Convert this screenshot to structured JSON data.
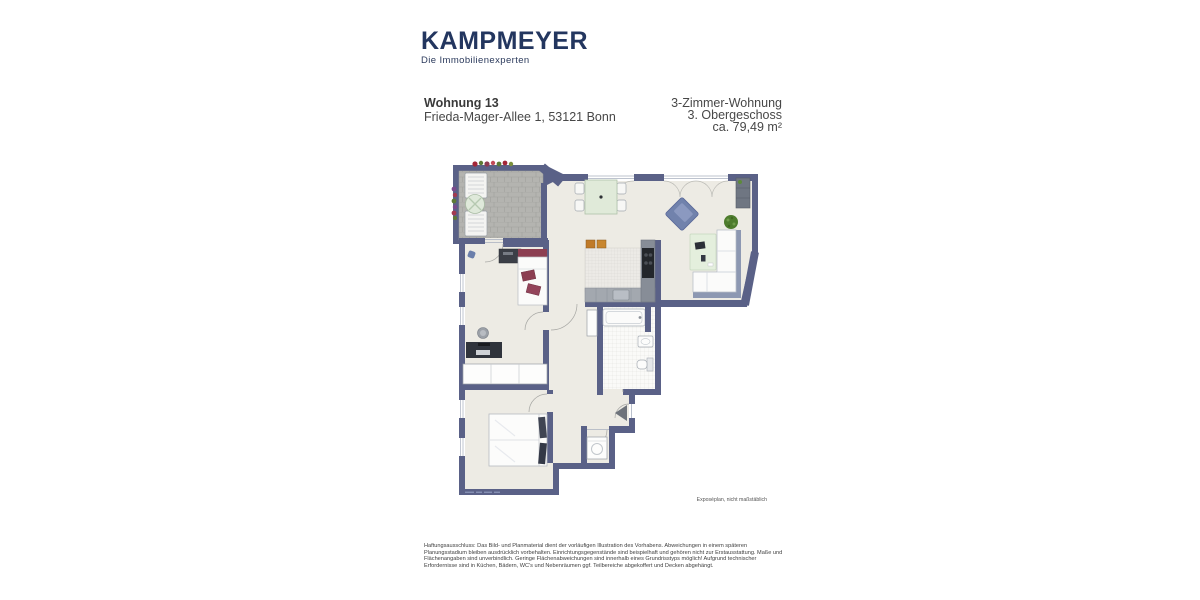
{
  "logo": {
    "brand": "KAMPMEYER",
    "tagline": "Die Immobilienexperten"
  },
  "header": {
    "unit_title": "Wohnung 13",
    "address": "Frieda-Mager-Allee 1, 53121 Bonn",
    "details": [
      "3-Zimmer-Wohnung",
      "3. Obergeschoss",
      "ca. 79,49 m²"
    ]
  },
  "floorplan": {
    "caption": "Exposéplan, nicht maßstäblich"
  },
  "disclaimer": {
    "lines": [
      "Haftungsausschluss: Das Bild- und Planmaterial dient der vorläufigen Illustration des Vorhabens. Abweichungen in einem späteren",
      "Planungsstadium bleiben ausdrücklich vorbehalten. Einrichtungsgegenstände sind beispielhaft und gehören nicht zur Erstausstattung. Maße und",
      "Flächenangaben sind unverbindlich. Geringe Flächenabweichungen sind innerhalb eines Grundrisstyps möglich! Aufgrund technischer",
      "Erfordernisse sind in Küchen, Bädern, WC's und Nebenräumen ggf. Teilbereiche abgekoffert und Decken abgehängt."
    ]
  },
  "colors": {
    "brand_navy": "#23365f",
    "wall": "#5a6187",
    "floor": "#edebe4"
  }
}
